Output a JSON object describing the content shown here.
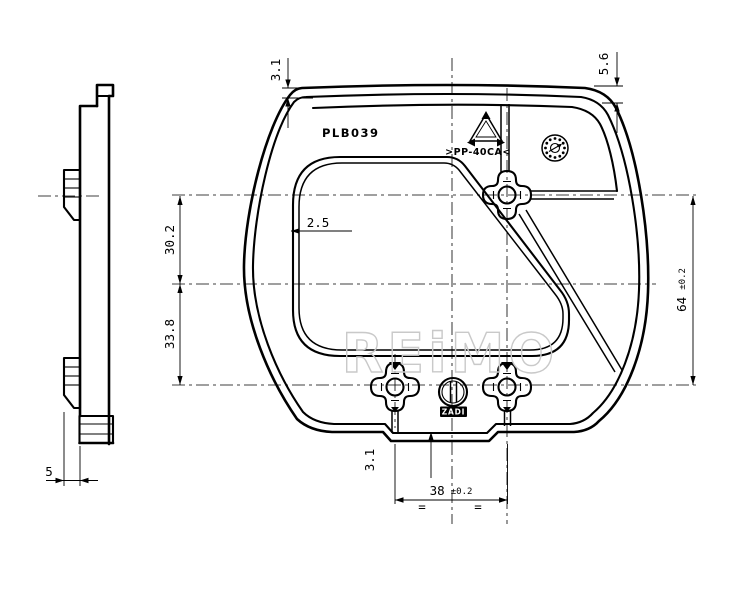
{
  "drawing": {
    "background": "#ffffff",
    "ink": "#000000",
    "watermark": {
      "text": "REiMO",
      "color": "#c9c9c9"
    },
    "labels": {
      "part_number": "PLB039",
      "material": ">PP-40CA<",
      "brand": "ZADI"
    },
    "symbols": {
      "recycling": "recycling-triangle",
      "date_stamp": "mold-date-wheel",
      "logo_mark": "zadi-roundel"
    },
    "dimensions": {
      "rim_top": "3.1",
      "top_right": "5.6",
      "upper_span": "30.2",
      "lower_span": "33.8",
      "overall_value": "64",
      "overall_tol": "±0.2",
      "wall": "2.5",
      "tab_offset": "3.1",
      "spacing_value": "38",
      "spacing_tol": "±0.2",
      "equal_mark": "=",
      "profile_thickness": "5"
    }
  }
}
